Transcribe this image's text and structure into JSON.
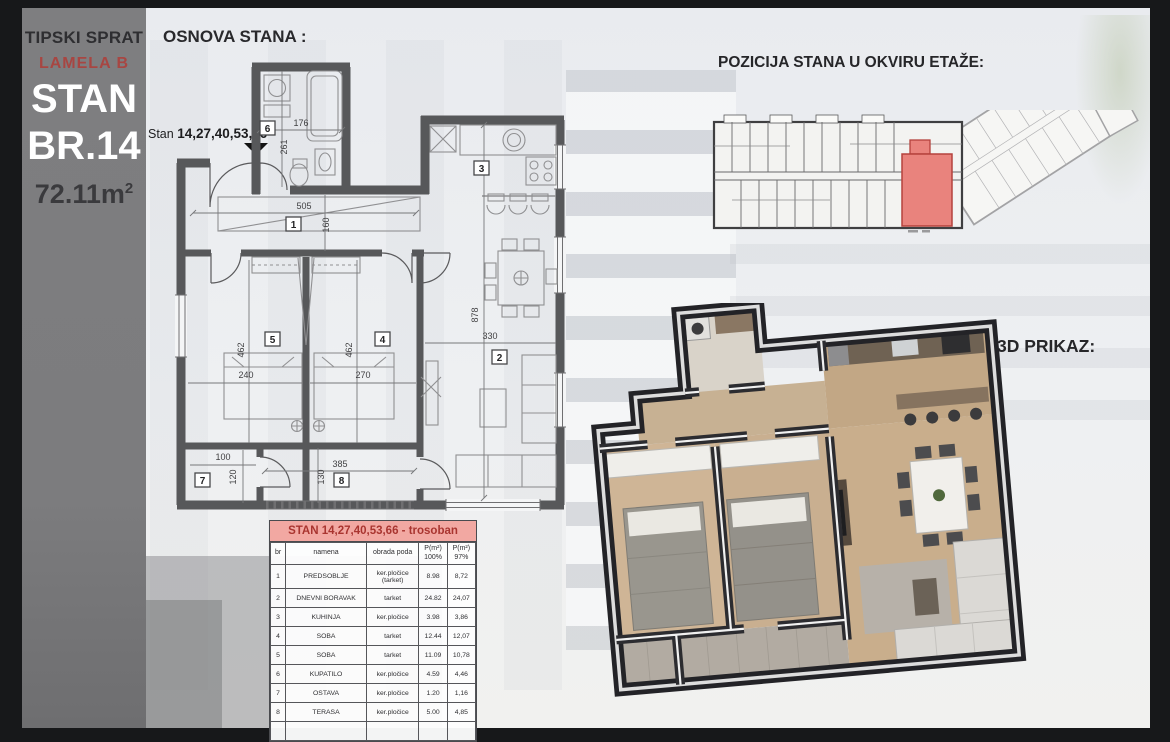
{
  "sidebar": {
    "floor_type": "TIPSKI SPRAT",
    "lamela": "LAMELA B",
    "unit_word": "STAN",
    "unit_number": "BR.14",
    "area_value": "72.11m",
    "area_sup": "2"
  },
  "plan": {
    "heading": "OSNOVA STANA :",
    "unit_label_prefix": "Stan ",
    "unit_label_numbers": "14,27,40,53,66",
    "room_numbers": [
      "1",
      "2",
      "3",
      "4",
      "5",
      "6",
      "7",
      "8"
    ],
    "dims": {
      "hall_w": "505",
      "hall_d": "160",
      "bath_w": "176",
      "bath_d": "261",
      "room5_d": "462",
      "room5_w": "240",
      "room4_d": "462",
      "room4_w": "270",
      "living_d": "878",
      "living_w": "330",
      "ostava_w": "100",
      "ostava_d": "120",
      "terrace_w": "385",
      "terrace_d": "130"
    }
  },
  "position": {
    "heading": "POZICIJA STANA U OKVIRU ETAŽE:"
  },
  "view3d": {
    "heading": "3D PRIKAZ:"
  },
  "table": {
    "title": "STAN 14,27,40,53,66 - trosoban",
    "col_br": "br",
    "col_namena": "namena",
    "col_obrada": "obrada poda",
    "col_p100_top": "P(m²)",
    "col_p100_bot": "100%",
    "col_p97_top": "P(m²)",
    "col_p97_bot": "97%",
    "rows": [
      {
        "br": "1",
        "namena": "PREDSOBLJE",
        "obrada": "ker.pločice (tarket)",
        "p100": "8.98",
        "p97": "8,72"
      },
      {
        "br": "2",
        "namena": "DNEVNI BORAVAK",
        "obrada": "tarket",
        "p100": "24.82",
        "p97": "24,07"
      },
      {
        "br": "3",
        "namena": "KUHINJA",
        "obrada": "ker.pločice",
        "p100": "3.98",
        "p97": "3,86"
      },
      {
        "br": "4",
        "namena": "SOBA",
        "obrada": "tarket",
        "p100": "12.44",
        "p97": "12,07"
      },
      {
        "br": "5",
        "namena": "SOBA",
        "obrada": "tarket",
        "p100": "11.09",
        "p97": "10,78"
      },
      {
        "br": "6",
        "namena": "KUPATILO",
        "obrada": "ker.pločice",
        "p100": "4.59",
        "p97": "4,46"
      },
      {
        "br": "7",
        "namena": "OSTAVA",
        "obrada": "ker.pločice",
        "p100": "1.20",
        "p97": "1,16"
      },
      {
        "br": "8",
        "namena": "TERASA",
        "obrada": "ker.pločice",
        "p100": "5.00",
        "p97": "4,85"
      }
    ]
  },
  "colors": {
    "highlight_red": "#e9837d",
    "lamela_red": "#a84642",
    "table_header_bg": "#f2a8a2",
    "table_header_text": "#a93530",
    "plan_wall_gray": "#57585a",
    "wall_dark_3d": "#232327",
    "sidebar_gray": "#7c7c7e"
  }
}
